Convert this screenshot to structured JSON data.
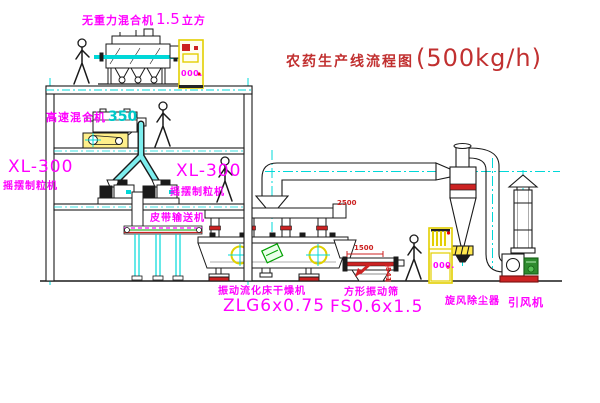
{
  "meta": {
    "width": 600,
    "height": 403,
    "drawing_type": "CAD process flow diagram"
  },
  "title": {
    "text": "农药生产线流程图",
    "capacity": "(500kg/h)"
  },
  "equipment_labels": {
    "gravity_mixer": {
      "name": "无重力混合机",
      "capacity": "1.5",
      "unit": "立方"
    },
    "high_speed_mixer": {
      "name": "高速混合机",
      "capacity": "350"
    },
    "granulator_left": {
      "model": "XL-300",
      "name": "摇摆制粒机"
    },
    "granulator_right": {
      "model": "XL-300",
      "name": "摇摆制粒机"
    },
    "belt_conveyor": {
      "name": "皮带输送机"
    },
    "fluid_bed_dryer": {
      "name": "振动流化床干燥机",
      "model": "ZLG6x0.75"
    },
    "vibrating_sieve": {
      "name": "方形振动筛",
      "model": "FS0.6x1.5"
    },
    "cyclone": {
      "name": "旋风除尘器"
    },
    "induced_draft_fan": {
      "name": "引风机"
    }
  },
  "control_cabinets": {
    "cabinet_a_display": "000.",
    "cabinet_b_display": "000."
  },
  "dimensions": {
    "sieve_width": "1500",
    "sieve_height": "541",
    "header_length": "2500"
  },
  "colors": {
    "line": "#1a1a1a",
    "magenta": "#ff00ff",
    "cyan": "#00d8d8",
    "red": "#cc2222",
    "yellow": "#e8d400",
    "green": "#00a000",
    "title_red": "#c13030"
  }
}
